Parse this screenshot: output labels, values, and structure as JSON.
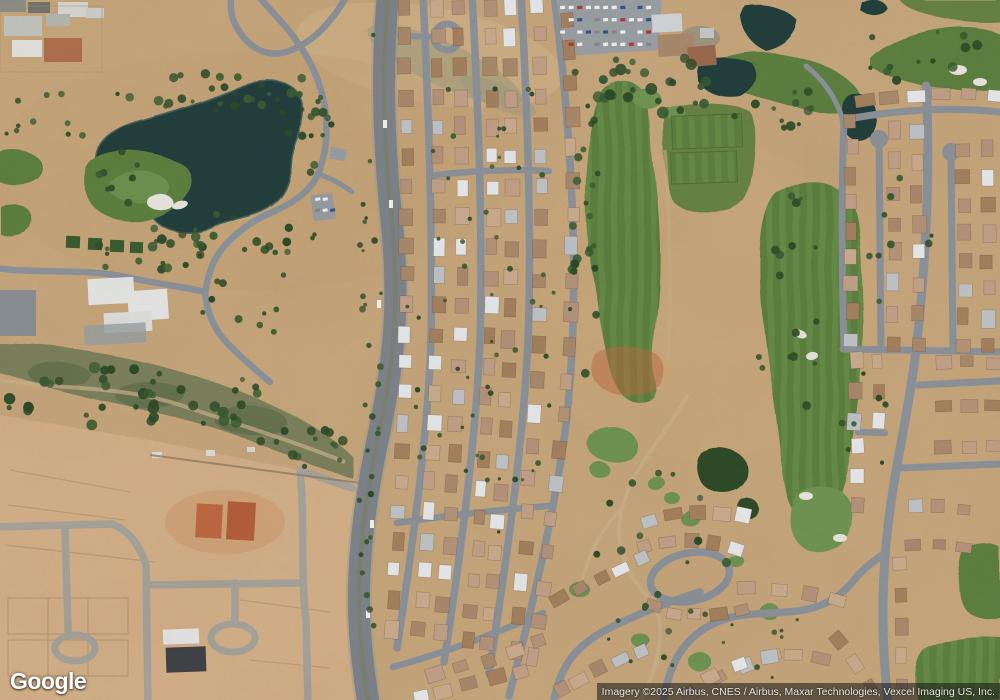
{
  "map": {
    "provider_logo": "Google",
    "attribution": "Imagery ©2025 Airbus, CNES / Airbus, Maxar Technologies, Vexcel Imaging US, Inc."
  },
  "colors": {
    "sand": "#c8a77c",
    "sand_light": "#d9b98e",
    "sand_constr": "#d5b189",
    "rough_band": "#b5a073",
    "water": "#24403c",
    "water_edge": "#46655c",
    "fairway": "#5d813f",
    "fairway_light": "#668c46",
    "green_bright": "#6f9552",
    "tree_dark": "#2d4b27",
    "tree_mid": "#3a5c31",
    "scrub": "#7d815c",
    "road": "#7f858c",
    "road_light": "#a7a49b",
    "street": "#8d939a",
    "path_tan": "#cbb48c",
    "bunker": "#eae7de",
    "orange_dirt": "#c06a42",
    "bldg_dark": "#3f4246",
    "bldg_white": "#e7e7e5",
    "roof_orange": "#b06f4c",
    "house_white": "#e9eaeb",
    "house_gray": "#c2c5c8",
    "attr_bg": "rgba(22,22,22,0.55)",
    "attr_text": "#e8e8e8"
  },
  "house_palette": [
    "#b6947a",
    "#c3a288",
    "#ab8a6c",
    "#ccad8f",
    "#a6825f"
  ],
  "house_rows": [
    {
      "p0": [
        404,
        8
      ],
      "c": [
        414,
        320
      ],
      "p1": [
        391,
        628
      ],
      "n": 22,
      "w": 15,
      "h": 12
    },
    {
      "p0": [
        436,
        8
      ],
      "c": [
        446,
        320
      ],
      "p1": [
        419,
        630
      ],
      "n": 22,
      "w": 15,
      "h": 12
    },
    {
      "p0": [
        459,
        8
      ],
      "c": [
        470,
        320
      ],
      "p1": [
        441,
        634
      ],
      "n": 22,
      "w": 15,
      "h": 12
    },
    {
      "p0": [
        490,
        8
      ],
      "c": [
        501,
        320
      ],
      "p1": [
        469,
        640
      ],
      "n": 22,
      "w": 15,
      "h": 12
    },
    {
      "p0": [
        509,
        8
      ],
      "c": [
        520,
        320
      ],
      "p1": [
        487,
        645
      ],
      "n": 22,
      "w": 15,
      "h": 12
    },
    {
      "p0": [
        538,
        6
      ],
      "c": [
        551,
        300
      ],
      "p1": [
        515,
        650
      ],
      "n": 21,
      "w": 15,
      "h": 12
    },
    {
      "p0": [
        566,
        20
      ],
      "c": [
        589,
        320
      ],
      "p1": [
        531,
        658
      ],
      "n": 20,
      "w": 16,
      "h": 12
    },
    {
      "p0": [
        437,
        676
      ],
      "c": [
        487,
        660
      ],
      "p1": [
        540,
        642
      ],
      "n": 5,
      "w": 15,
      "h": 12
    },
    {
      "p0": [
        420,
        696
      ],
      "c": [
        468,
        686
      ],
      "p1": [
        522,
        670
      ],
      "n": 5,
      "w": 15,
      "h": 12
    },
    {
      "p0": [
        864,
        100
      ],
      "c": [
        928,
        90
      ],
      "p1": [
        996,
        97
      ],
      "n": 6,
      "w": 16,
      "h": 12
    },
    {
      "p0": [
        851,
        120
      ],
      "c": [
        853,
        230
      ],
      "p1": [
        851,
        340
      ],
      "n": 9,
      "w": 15,
      "h": 12
    },
    {
      "p0": [
        893,
        132
      ],
      "c": [
        895,
        238
      ],
      "p1": [
        893,
        344
      ],
      "n": 8,
      "w": 15,
      "h": 12
    },
    {
      "p0": [
        917,
        132
      ],
      "c": [
        919,
        238
      ],
      "p1": [
        917,
        344
      ],
      "n": 8,
      "w": 15,
      "h": 12
    },
    {
      "p0": [
        963,
        150
      ],
      "c": [
        965,
        248
      ],
      "p1": [
        963,
        345
      ],
      "n": 8,
      "w": 15,
      "h": 12
    },
    {
      "p0": [
        987,
        150
      ],
      "c": [
        989,
        248
      ],
      "p1": [
        987,
        345
      ],
      "n": 8,
      "w": 15,
      "h": 12
    },
    {
      "p0": [
        942,
        363
      ],
      "c": [
        968,
        362
      ],
      "p1": [
        995,
        363
      ],
      "n": 3,
      "w": 15,
      "h": 12
    },
    {
      "p0": [
        942,
        405
      ],
      "c": [
        968,
        404
      ],
      "p1": [
        995,
        405
      ],
      "n": 3,
      "w": 15,
      "h": 12
    },
    {
      "p0": [
        942,
        447
      ],
      "c": [
        968,
        446
      ],
      "p1": [
        995,
        447
      ],
      "n": 3,
      "w": 15,
      "h": 12
    },
    {
      "p0": [
        855,
        362
      ],
      "c": [
        857,
        392
      ],
      "p1": [
        855,
        422
      ],
      "n": 3,
      "w": 15,
      "h": 12
    },
    {
      "p0": [
        879,
        360
      ],
      "c": [
        881,
        390
      ],
      "p1": [
        879,
        420
      ],
      "n": 3,
      "w": 14,
      "h": 11
    },
    {
      "p0": [
        856,
        446
      ],
      "c": [
        858,
        476
      ],
      "p1": [
        856,
        506
      ],
      "n": 3,
      "w": 15,
      "h": 12
    },
    {
      "p0": [
        648,
        520
      ],
      "c": [
        696,
        506
      ],
      "p1": [
        744,
        516
      ],
      "n": 5,
      "w": 15,
      "h": 12
    },
    {
      "p0": [
        645,
        547
      ],
      "c": [
        690,
        534
      ],
      "p1": [
        736,
        549
      ],
      "n": 5,
      "w": 15,
      "h": 12
    },
    {
      "p0": [
        652,
        607
      ],
      "c": [
        696,
        622
      ],
      "p1": [
        740,
        610
      ],
      "n": 5,
      "w": 15,
      "h": 12
    },
    {
      "p0": [
        560,
        600
      ],
      "c": [
        600,
        577
      ],
      "p1": [
        642,
        558
      ],
      "n": 5,
      "w": 15,
      "h": 12
    },
    {
      "p0": [
        560,
        690
      ],
      "c": [
        600,
        668
      ],
      "p1": [
        640,
        650
      ],
      "n": 5,
      "w": 15,
      "h": 12
    },
    {
      "p0": [
        690,
        695
      ],
      "c": [
        730,
        665
      ],
      "p1": [
        775,
        655
      ],
      "n": 4,
      "w": 15,
      "h": 12
    },
    {
      "p0": [
        748,
        588
      ],
      "c": [
        793,
        587
      ],
      "p1": [
        838,
        600
      ],
      "n": 4,
      "w": 15,
      "h": 12
    },
    {
      "p0": [
        712,
        676
      ],
      "c": [
        768,
        646
      ],
      "p1": [
        822,
        658
      ],
      "n": 5,
      "w": 15,
      "h": 12
    },
    {
      "p0": [
        838,
        640
      ],
      "c": [
        856,
        662
      ],
      "p1": [
        870,
        688
      ],
      "n": 3,
      "w": 14,
      "h": 11
    },
    {
      "p0": [
        900,
        565
      ],
      "c": [
        904,
        625
      ],
      "p1": [
        901,
        688
      ],
      "n": 5,
      "w": 15,
      "h": 12
    },
    {
      "p0": [
        914,
        507
      ],
      "c": [
        938,
        506
      ],
      "p1": [
        962,
        508
      ],
      "n": 3,
      "w": 14,
      "h": 11
    },
    {
      "p0": [
        914,
        545
      ],
      "c": [
        938,
        544
      ],
      "p1": [
        962,
        547
      ],
      "n": 3,
      "w": 14,
      "h": 11
    }
  ],
  "tree_clusters": [
    {
      "cx": 210,
      "cy": 92,
      "rx": 95,
      "ry": 20,
      "n": 26,
      "rmin": 2,
      "rmax": 5
    },
    {
      "cx": 235,
      "cy": 235,
      "rx": 85,
      "ry": 22,
      "n": 22,
      "rmin": 2,
      "rmax": 5
    },
    {
      "cx": 305,
      "cy": 130,
      "rx": 35,
      "ry": 55,
      "n": 16,
      "rmin": 2,
      "rmax": 5
    },
    {
      "cx": 150,
      "cy": 255,
      "rx": 65,
      "ry": 22,
      "n": 14,
      "rmin": 2,
      "rmax": 5
    },
    {
      "cx": 55,
      "cy": 120,
      "rx": 55,
      "ry": 35,
      "n": 10,
      "rmin": 2,
      "rmax": 4
    },
    {
      "cx": 140,
      "cy": 400,
      "rx": 135,
      "ry": 38,
      "n": 40,
      "rmin": 2.5,
      "rmax": 6
    },
    {
      "cx": 300,
      "cy": 448,
      "rx": 55,
      "ry": 22,
      "n": 14,
      "rmin": 2,
      "rmax": 5
    },
    {
      "cx": 585,
      "cy": 260,
      "rx": 16,
      "ry": 170,
      "n": 22,
      "rmin": 2,
      "rmax": 4.5
    },
    {
      "cx": 640,
      "cy": 82,
      "rx": 75,
      "ry": 42,
      "n": 26,
      "rmin": 2.5,
      "rmax": 6
    },
    {
      "cx": 770,
      "cy": 108,
      "rx": 55,
      "ry": 25,
      "n": 12,
      "rmin": 2,
      "rmax": 5
    },
    {
      "cx": 792,
      "cy": 310,
      "rx": 38,
      "ry": 115,
      "n": 16,
      "rmin": 2,
      "rmax": 4.5
    },
    {
      "cx": 680,
      "cy": 555,
      "rx": 95,
      "ry": 85,
      "n": 14,
      "rmin": 2,
      "rmax": 5
    },
    {
      "cx": 700,
      "cy": 645,
      "rx": 120,
      "ry": 45,
      "n": 16,
      "rmin": 1.5,
      "rmax": 3.5
    },
    {
      "cx": 925,
      "cy": 55,
      "rx": 72,
      "ry": 28,
      "n": 12,
      "rmin": 2,
      "rmax": 5
    },
    {
      "cx": 900,
      "cy": 245,
      "rx": 35,
      "ry": 80,
      "n": 9,
      "rmin": 2,
      "rmax": 4
    },
    {
      "cx": 480,
      "cy": 300,
      "rx": 75,
      "ry": 290,
      "n": 55,
      "rmin": 1.5,
      "rmax": 3
    },
    {
      "cx": 370,
      "cy": 350,
      "rx": 12,
      "ry": 330,
      "n": 30,
      "rmin": 1.5,
      "rmax": 3.5
    },
    {
      "cx": 250,
      "cy": 300,
      "rx": 60,
      "ry": 40,
      "n": 10,
      "rmin": 2,
      "rmax": 4.5
    },
    {
      "cx": 118,
      "cy": 178,
      "rx": 26,
      "ry": 30,
      "n": 8,
      "rmin": 2,
      "rmax": 4
    },
    {
      "cx": 860,
      "cy": 430,
      "rx": 30,
      "ry": 60,
      "n": 8,
      "rmin": 1.5,
      "rmax": 3.5
    }
  ],
  "parking_lots": [
    {
      "x": 560,
      "y": 6,
      "cols": 11,
      "rows": 4,
      "dx": 8.6,
      "dy": 12.3,
      "w": 5,
      "h": 3.2,
      "angle": -4
    },
    {
      "x": 315,
      "y": 198,
      "cols": 3,
      "rows": 2,
      "dx": 7.5,
      "dy": 11,
      "w": 5,
      "h": 3,
      "angle": -8
    }
  ],
  "vehicles": [
    {
      "x": 383,
      "y": 120
    },
    {
      "x": 377,
      "y": 300
    },
    {
      "x": 370,
      "y": 520
    },
    {
      "x": 366,
      "y": 610
    },
    {
      "x": 389,
      "y": 200
    }
  ],
  "seed": 7
}
